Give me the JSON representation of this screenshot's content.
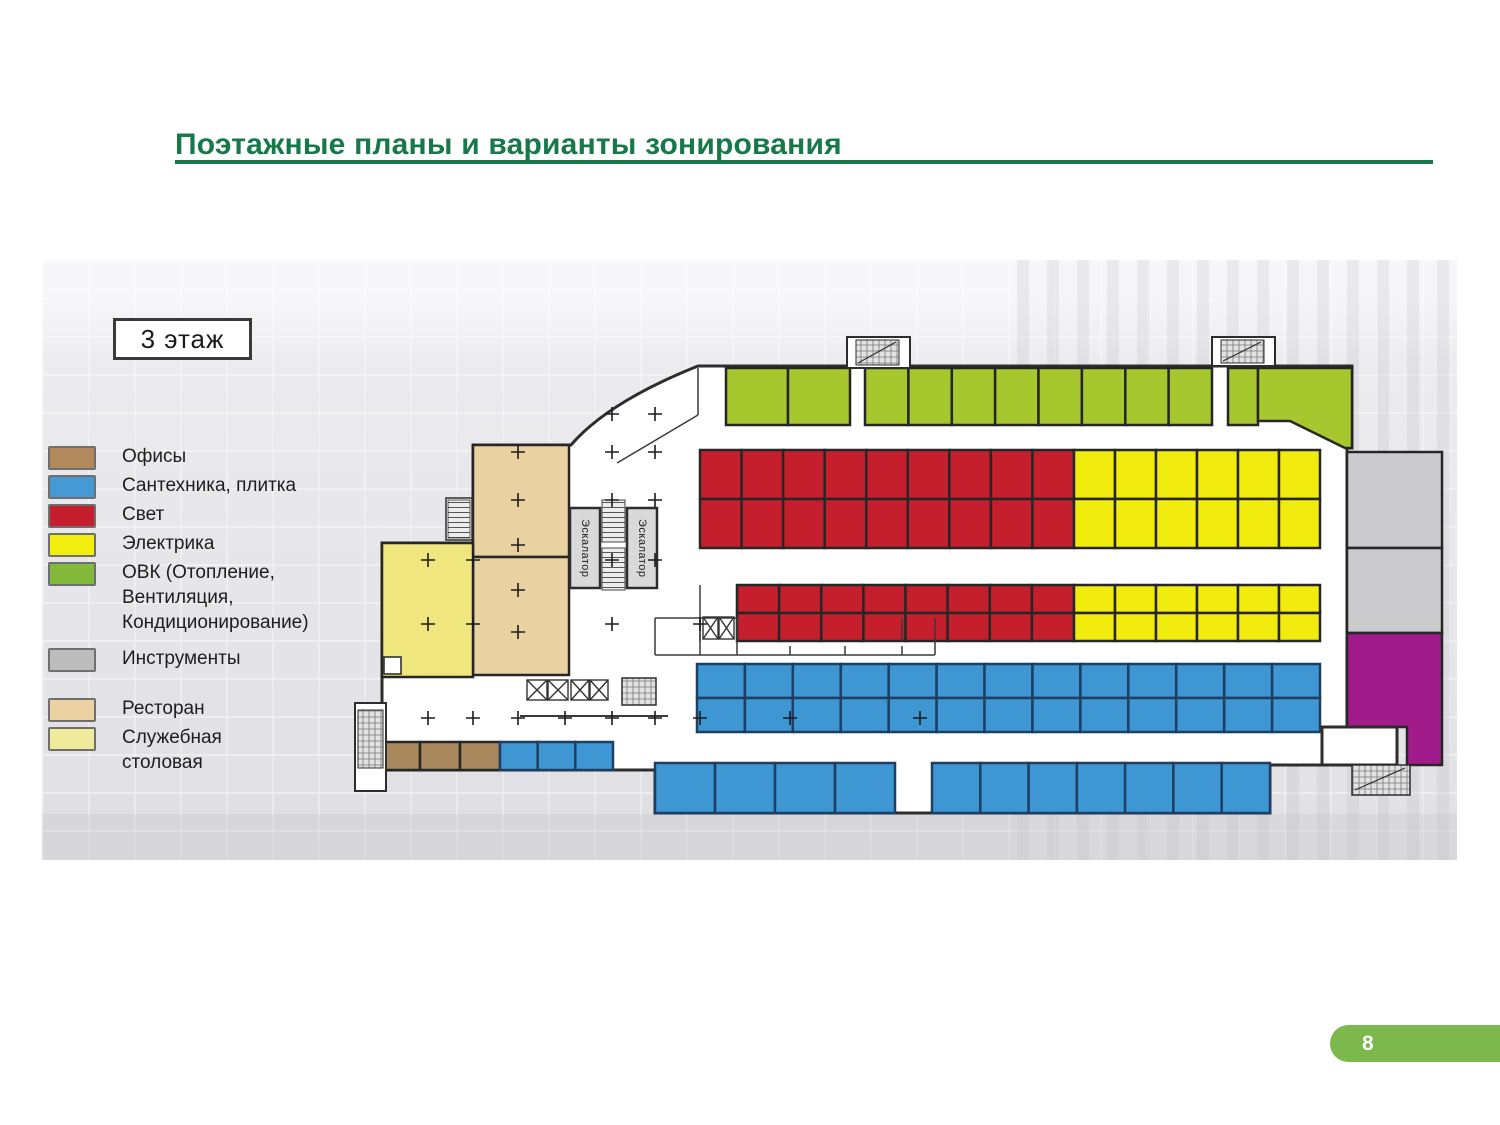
{
  "slide": {
    "title": "Поэтажные планы и варианты зонирования",
    "page_number": "8"
  },
  "floor_plan": {
    "floor_label": "3 этаж",
    "escalator_label": "Эскалатор"
  },
  "legend": {
    "items": [
      {
        "key": "offices",
        "label": "Офисы",
        "color": "#b1895c"
      },
      {
        "key": "plumbing",
        "label": "Сантехника, плитка",
        "color": "#459ad5"
      },
      {
        "key": "light",
        "label": "Свет",
        "color": "#c51f2e"
      },
      {
        "key": "electrics",
        "label": "Электрика",
        "color": "#f2ee0f"
      },
      {
        "key": "hvac",
        "label": "ОВК (Отопление,\nВентиляция,\nКондиционирование)",
        "color": "#84ba3c"
      },
      {
        "key": "tools",
        "label": "Инструменты",
        "color": "#bcbcbc"
      },
      {
        "key": "restaurant",
        "label": "Ресторан",
        "color": "#ecd2a2"
      },
      {
        "key": "canteen",
        "label": "Служебная\nстоловая",
        "color": "#f0eb9a"
      }
    ]
  },
  "colors": {
    "offices": "#a9885e",
    "plumbing": "#3e97d3",
    "light": "#c51f2e",
    "electrics": "#f1ec0e",
    "hvac": "#a6c72e",
    "tools": "#cbcbcd",
    "restaurant": "#e9d1a2",
    "canteen": "#efe77d",
    "unassigned": "#a11b8b",
    "title": "#177849",
    "badge": "#7cb84c"
  }
}
